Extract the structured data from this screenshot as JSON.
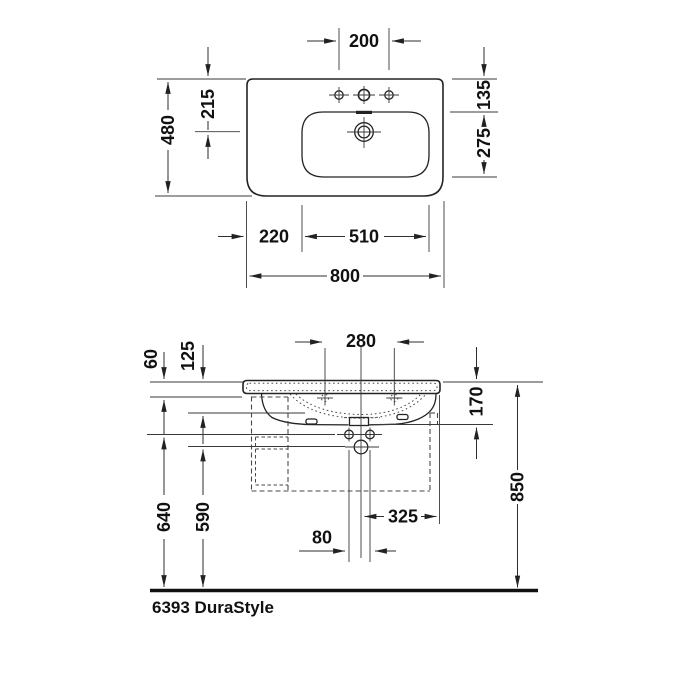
{
  "caption": "6393 DuraStyle",
  "top_view": {
    "faucet_hole_spacing": "200",
    "overall_depth": "480",
    "drain_center_from_back": "215",
    "basin_inset_back": "135",
    "basin_inner_depth": "275",
    "left_deck_width": "220",
    "basin_inner_width": "510",
    "overall_width": "800"
  },
  "front_view": {
    "mounting_hole_spacing": "280",
    "rim_height": "60",
    "body_height": "125",
    "outlet_depth": "170",
    "mounting_height": "640",
    "siphon_height": "590",
    "overall_height": "850",
    "outlet_to_right_edge": "325",
    "fixing_bolt_spacing": "80"
  },
  "colors": {
    "outline": "#232323",
    "thin_line": "#3a3a3a",
    "dashed": "#4a4a4a",
    "text": "#111111",
    "background": "#ffffff"
  }
}
